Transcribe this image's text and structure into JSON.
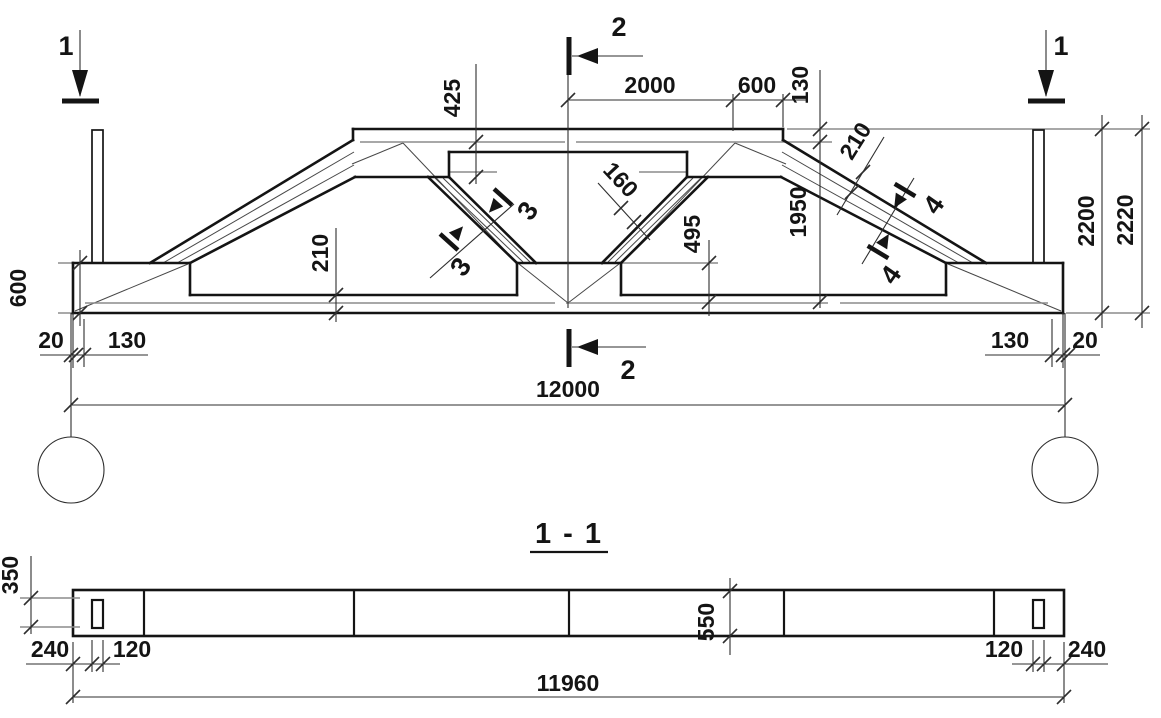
{
  "title": "1 - 1",
  "colors": {
    "ink": "#141414",
    "aux_gray": "#8c8c8c",
    "background": "#ffffff"
  },
  "markers": {
    "s1": "1",
    "s2": "2",
    "s3": "3",
    "s4": "4"
  },
  "elev": {
    "span": "12000",
    "topMidHalf": "2000",
    "topEnd": "600",
    "topStep": "130",
    "chordDepth": "425",
    "webHeight": "1950",
    "nodeHeight": "495",
    "diagThk": "210",
    "innerDiagThk": "160",
    "bottomChordThk": "210",
    "supportHeight": "600",
    "gap": "20",
    "bearing": "130",
    "heightInner": "2200",
    "heightTotal": "2220"
  },
  "plan": {
    "length": "11960",
    "endDepth": "350",
    "holeInset": "240",
    "holeW": "120",
    "midDepth": "550"
  }
}
